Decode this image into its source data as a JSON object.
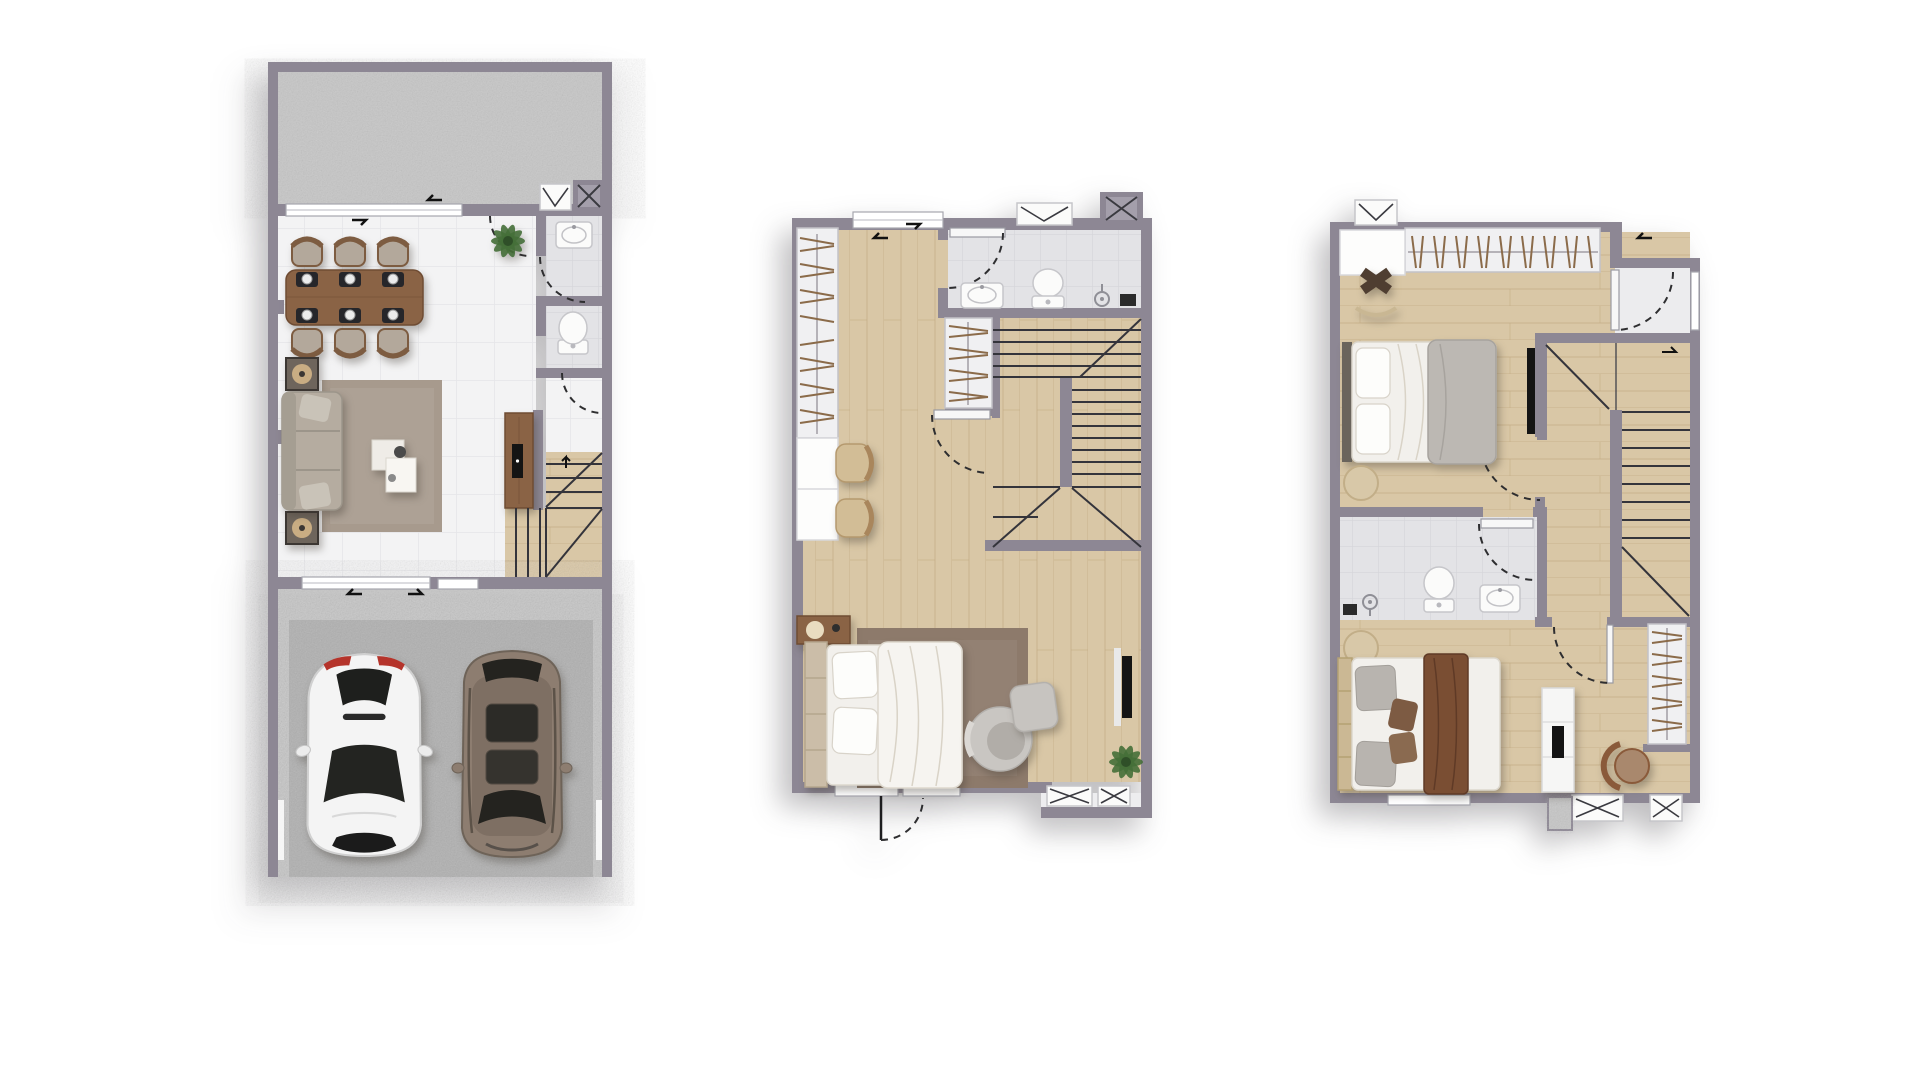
{
  "palette": {
    "background": "#ffffff",
    "wall": "#8d8794",
    "wall_inner": "#a6a1ae",
    "floor_tile": "#f3f3f4",
    "tile_line": "#e5e5e8",
    "bath_tile": "#e3e3e6",
    "bath_tile_line": "#d5d5d9",
    "wood": "#d9c7a6",
    "wood_line": "#c5ae87",
    "concrete": "#c6c6c6",
    "concrete_dark": "#b0b0b0",
    "furniture_wood": "#8a6345",
    "hanger": "#8b6b4a",
    "sofa_fabric": "#b5aca0",
    "rug_gray": "#a79a8d",
    "rug_brown": "#8d7a6b",
    "linen_white": "#f2f0ec",
    "duvet_gray": "#bcb8b3",
    "blanket_brown": "#7a4e33",
    "tan_leather": "#d2bd96",
    "plant_green": "#456f38",
    "car_white": "#f4f4f4",
    "car_suv": "#8d7d70",
    "glass_dark": "#24231f",
    "line_dark": "#2e2e30",
    "fixture_white": "#fbfbfa",
    "door_white": "#f7f7f7"
  },
  "floors": [
    {
      "label": "first-floor-plan",
      "rooms": [
        "terrace",
        "living-dining-room",
        "powder-room",
        "wc",
        "hallway",
        "staircase",
        "garage"
      ],
      "furniture": [
        {
          "item": "dining-table",
          "count": 1
        },
        {
          "item": "dining-chair",
          "count": 6
        },
        {
          "item": "place-setting",
          "count": 6
        },
        {
          "item": "potted-plant",
          "count": 1
        },
        {
          "item": "sofa",
          "count": 1
        },
        {
          "item": "side-table",
          "count": 2
        },
        {
          "item": "area-rug",
          "count": 1
        },
        {
          "item": "coffee-table",
          "count": 1
        },
        {
          "item": "media-console",
          "count": 1
        },
        {
          "item": "washbasin",
          "count": 1
        },
        {
          "item": "toilet",
          "count": 1
        },
        {
          "item": "car",
          "count": 2
        }
      ]
    },
    {
      "label": "second-floor-plan",
      "rooms": [
        "bedroom",
        "bathroom",
        "wardrobe",
        "hallway",
        "staircase"
      ],
      "furniture": [
        {
          "item": "wardrobe-rail",
          "count": 2
        },
        {
          "item": "vanity-desk",
          "count": 1
        },
        {
          "item": "desk-chair",
          "count": 2
        },
        {
          "item": "washbasin",
          "count": 1
        },
        {
          "item": "toilet",
          "count": 1
        },
        {
          "item": "shower-head",
          "count": 1
        },
        {
          "item": "double-bed",
          "count": 1
        },
        {
          "item": "nightstand",
          "count": 1
        },
        {
          "item": "area-rug",
          "count": 1
        },
        {
          "item": "armchair",
          "count": 1
        },
        {
          "item": "ottoman",
          "count": 1
        },
        {
          "item": "wall-tv",
          "count": 1
        },
        {
          "item": "potted-plant",
          "count": 1
        }
      ]
    },
    {
      "label": "third-floor-plan",
      "rooms": [
        "bedroom",
        "master-bedroom",
        "bathroom",
        "landing",
        "staircase",
        "wardrobe"
      ],
      "furniture": [
        {
          "item": "wardrobe-rail",
          "count": 2
        },
        {
          "item": "desk",
          "count": 1
        },
        {
          "item": "stool",
          "count": 1
        },
        {
          "item": "double-bed",
          "count": 2
        },
        {
          "item": "round-rug",
          "count": 2
        },
        {
          "item": "wall-tv",
          "count": 1
        },
        {
          "item": "tv-cabinet",
          "count": 1
        },
        {
          "item": "toilet",
          "count": 1
        },
        {
          "item": "washbasin",
          "count": 1
        },
        {
          "item": "shower-head",
          "count": 1
        },
        {
          "item": "accent-chair",
          "count": 1
        }
      ]
    }
  ]
}
